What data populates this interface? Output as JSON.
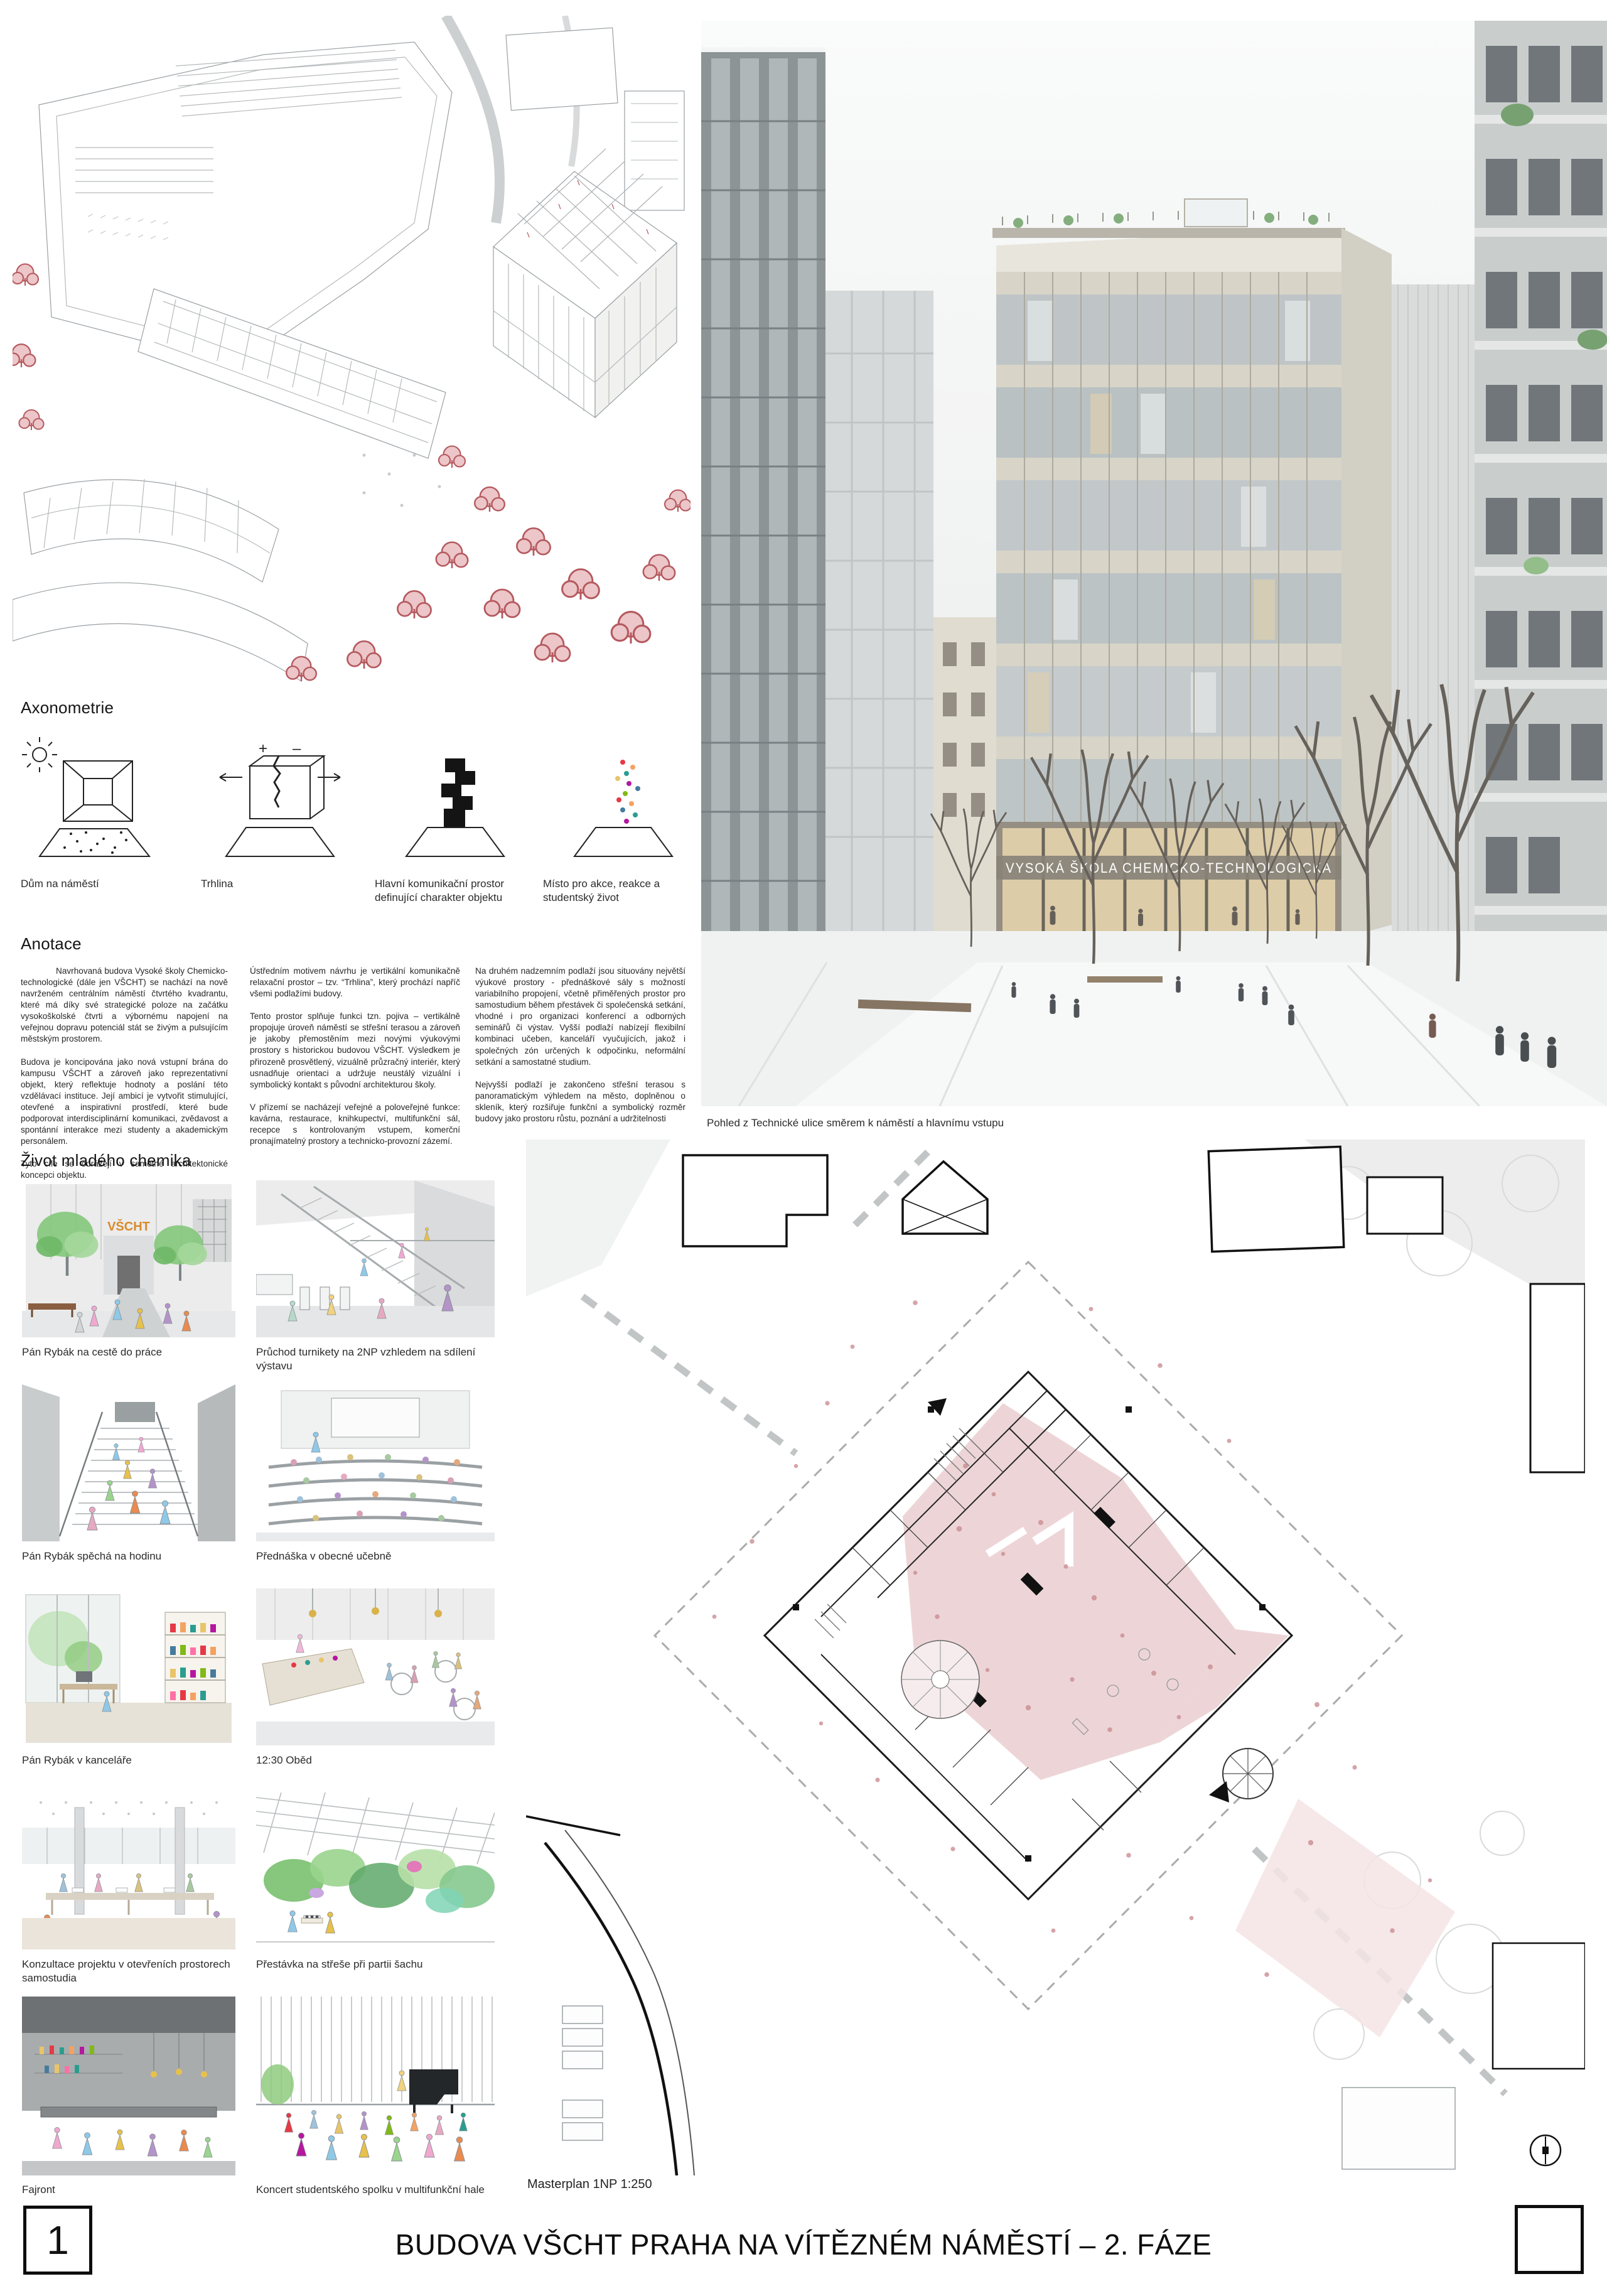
{
  "colors": {
    "ink": "#1c1c1c",
    "axon_tree_red": "#b5595f",
    "plan_pink": "#edd5d7",
    "sketch_green": "#86c87d",
    "sketch_signage_orange": "#d98a2b"
  },
  "axonometry": {
    "heading": "Axonometrie",
    "concepts": [
      {
        "label": "Dům na náměstí"
      },
      {
        "label": "Trhlina",
        "marks": [
          "+",
          "–"
        ]
      },
      {
        "label": "Hlavní komunikační prostor definující charakter objektu"
      },
      {
        "label": "Místo pro akce, reakce a studentský život"
      }
    ]
  },
  "annotation": {
    "heading": "Anotace",
    "columns": [
      {
        "paragraphs": [
          "Navrhovaná budova Vysoké školy Chemicko-technologické (dále jen VŠCHT) se nachází na nově navrženém centrálním náměstí čtvrtého kvadrantu, které má díky své strategické poloze na začátku vysokoškolské čtvrti a výbornému napojení na veřejnou dopravu potenciál stát se živým a pulsujícím městským prostorem.",
          "Budova je koncipována jako nová vstupní brána do kampusu VŠCHT a zároveň jako reprezentativní objekt, který reflektuje hodnoty a poslání této vzdělávací instituce. Její ambicí je vytvořit stimulující, otevřené a inspirativní prostředí, které bude podporovat interdisciplinární komunikaci, zvědavost a spontánní interakce mezi studenty a akademickým personálem.",
          "Tyto cíle se odrážejí v samotné architektonické koncepci objektu."
        ]
      },
      {
        "paragraphs": [
          "Ústředním motivem návrhu je vertikální komunikačně relaxační prostor – tzv. “Trhlina”, který prochází napříč všemi podlažími budovy.",
          "Tento prostor splňuje funkci tzn. pojiva – vertikálně propojuje úroveň náměstí se střešní terasou a zároveň je jakoby přemostěním mezi novými výukovými prostory s historickou budovou VŠCHT. Výsledkem je přirozeně prosvětlený, vizuálně průzračný interiér, který usnadňuje orientaci a udržuje neustálý vizuální i symbolický kontakt s původní architekturou školy.",
          "V přízemí se nacházejí veřejné a poloveřejné funkce: kavárna, restaurace, knihkupectví, multifunkční sál, recepce s kontrolovaným vstupem, komerční pronajímatelný prostory a technicko-provozní zázemí."
        ]
      },
      {
        "paragraphs": [
          "Na druhém nadzemním podlaží jsou situovány největší výukové prostory - přednáškové sály s možností variabilního propojení, včetně přiměřených prostor pro samostudium během přestávek či společenská setkání, vhodné i pro organizaci konferencí a odborných seminářů či výstav. Vyšší podlaží nabízejí flexibilní kombinaci učeben, kanceláří vyučujících, jakož i společných zón určených k odpočinku, neformální setkání a samostatné studium.",
          "Nejvyšší podlaží je zakončeno střešní terasou s panoramatickým výhledem na město, doplněnou o skleník, který rozšiřuje funkční a symbolický rozměr budovy jako prostoru růstu, poznání a udržitelnosti"
        ]
      }
    ]
  },
  "hero_render": {
    "caption": "Pohled z Technické ulice směrem k náměstí a hlavnímu vstupu",
    "building_signage": "VYSOKÁ ŠKOLA CHEMICKO-TECHNOLOGICKÁ"
  },
  "day_in_life": {
    "heading": "Život mladého chemika",
    "sketch_signage": "VŠCHT",
    "vignettes": [
      {
        "caption": "Pán Rybák na cestě do práce"
      },
      {
        "caption": "Průchod turnikety na 2NP vzhledem na sdílení výstavu"
      },
      {
        "caption": "Pán Rybák spěchá na hodinu"
      },
      {
        "caption": "Přednáška v obecné učebně"
      },
      {
        "caption": "Pán Rybák v kanceláře"
      },
      {
        "caption": "12:30 Oběd"
      },
      {
        "caption": "Konzultace projektu v otevřeních prostorech samostudia"
      },
      {
        "caption": "Přestávka na střeše při partii šachu"
      },
      {
        "caption": "Fajront"
      },
      {
        "caption": "Koncert studentského spolku v multifunkční hale"
      }
    ]
  },
  "masterplan": {
    "label": "Masterplan 1NP 1:250"
  },
  "footer": {
    "sheet_number": "1",
    "title": "BUDOVA VŠCHT PRAHA NA VÍTĚZNÉM NÁMĚSTÍ – 2. FÁZE"
  }
}
